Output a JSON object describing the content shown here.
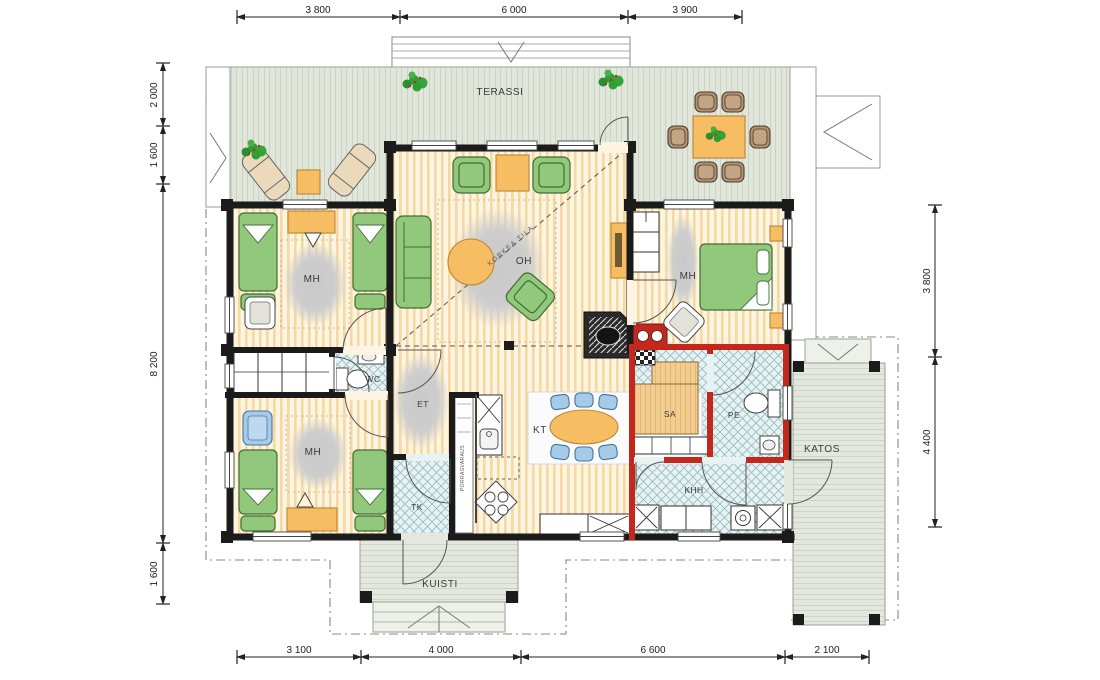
{
  "drawing": {
    "type": "architectural floor plan",
    "language": "Finnish"
  },
  "rooms": {
    "terassi": {
      "label": "TERASSI"
    },
    "mh_top_left": {
      "label": "MH"
    },
    "mh_bottom_left": {
      "label": "MH"
    },
    "mh_right": {
      "label": "MH"
    },
    "oh": {
      "label": "OH"
    },
    "et": {
      "label": "ET"
    },
    "wc": {
      "label": "WC"
    },
    "kt": {
      "label": "KT"
    },
    "tk": {
      "label": "TK"
    },
    "sa": {
      "label": "SA"
    },
    "pe": {
      "label": "PE"
    },
    "khh": {
      "label": "KHH"
    },
    "kuisti": {
      "label": "KUISTI"
    },
    "katos": {
      "label": "KATOS"
    }
  },
  "annotations": {
    "korkea_tila": "KORKEA TILA",
    "porrasvaraus": "PORRASVARAUS"
  },
  "dimensions": {
    "top": [
      "3 800",
      "6 000",
      "3 900"
    ],
    "bottom": [
      "3 100",
      "4 000",
      "6 600",
      "2 100"
    ],
    "left": [
      "2 000",
      "1 600",
      "8 200",
      "1 600"
    ],
    "right": [
      "3 800",
      "4 400"
    ]
  },
  "colors": {
    "wall": "#1b1b1b",
    "wet_room_wall": "#c4271b",
    "deck": "#e1e6db",
    "deck_stripe": "#b6c0af",
    "floor": "#fdf4e1",
    "floor_stripe": "#f6d9a2",
    "tile": "#e7f2f3",
    "tile_line": "#96bac2",
    "furniture_green": "#92c87c",
    "furniture_orange": "#f7bd62",
    "furniture_blue": "#a6cbe8",
    "chair_brown": "#b29272",
    "sauna_wood": "#f3cd90",
    "rug": "#cccccc",
    "plant": "#2f9e33"
  }
}
